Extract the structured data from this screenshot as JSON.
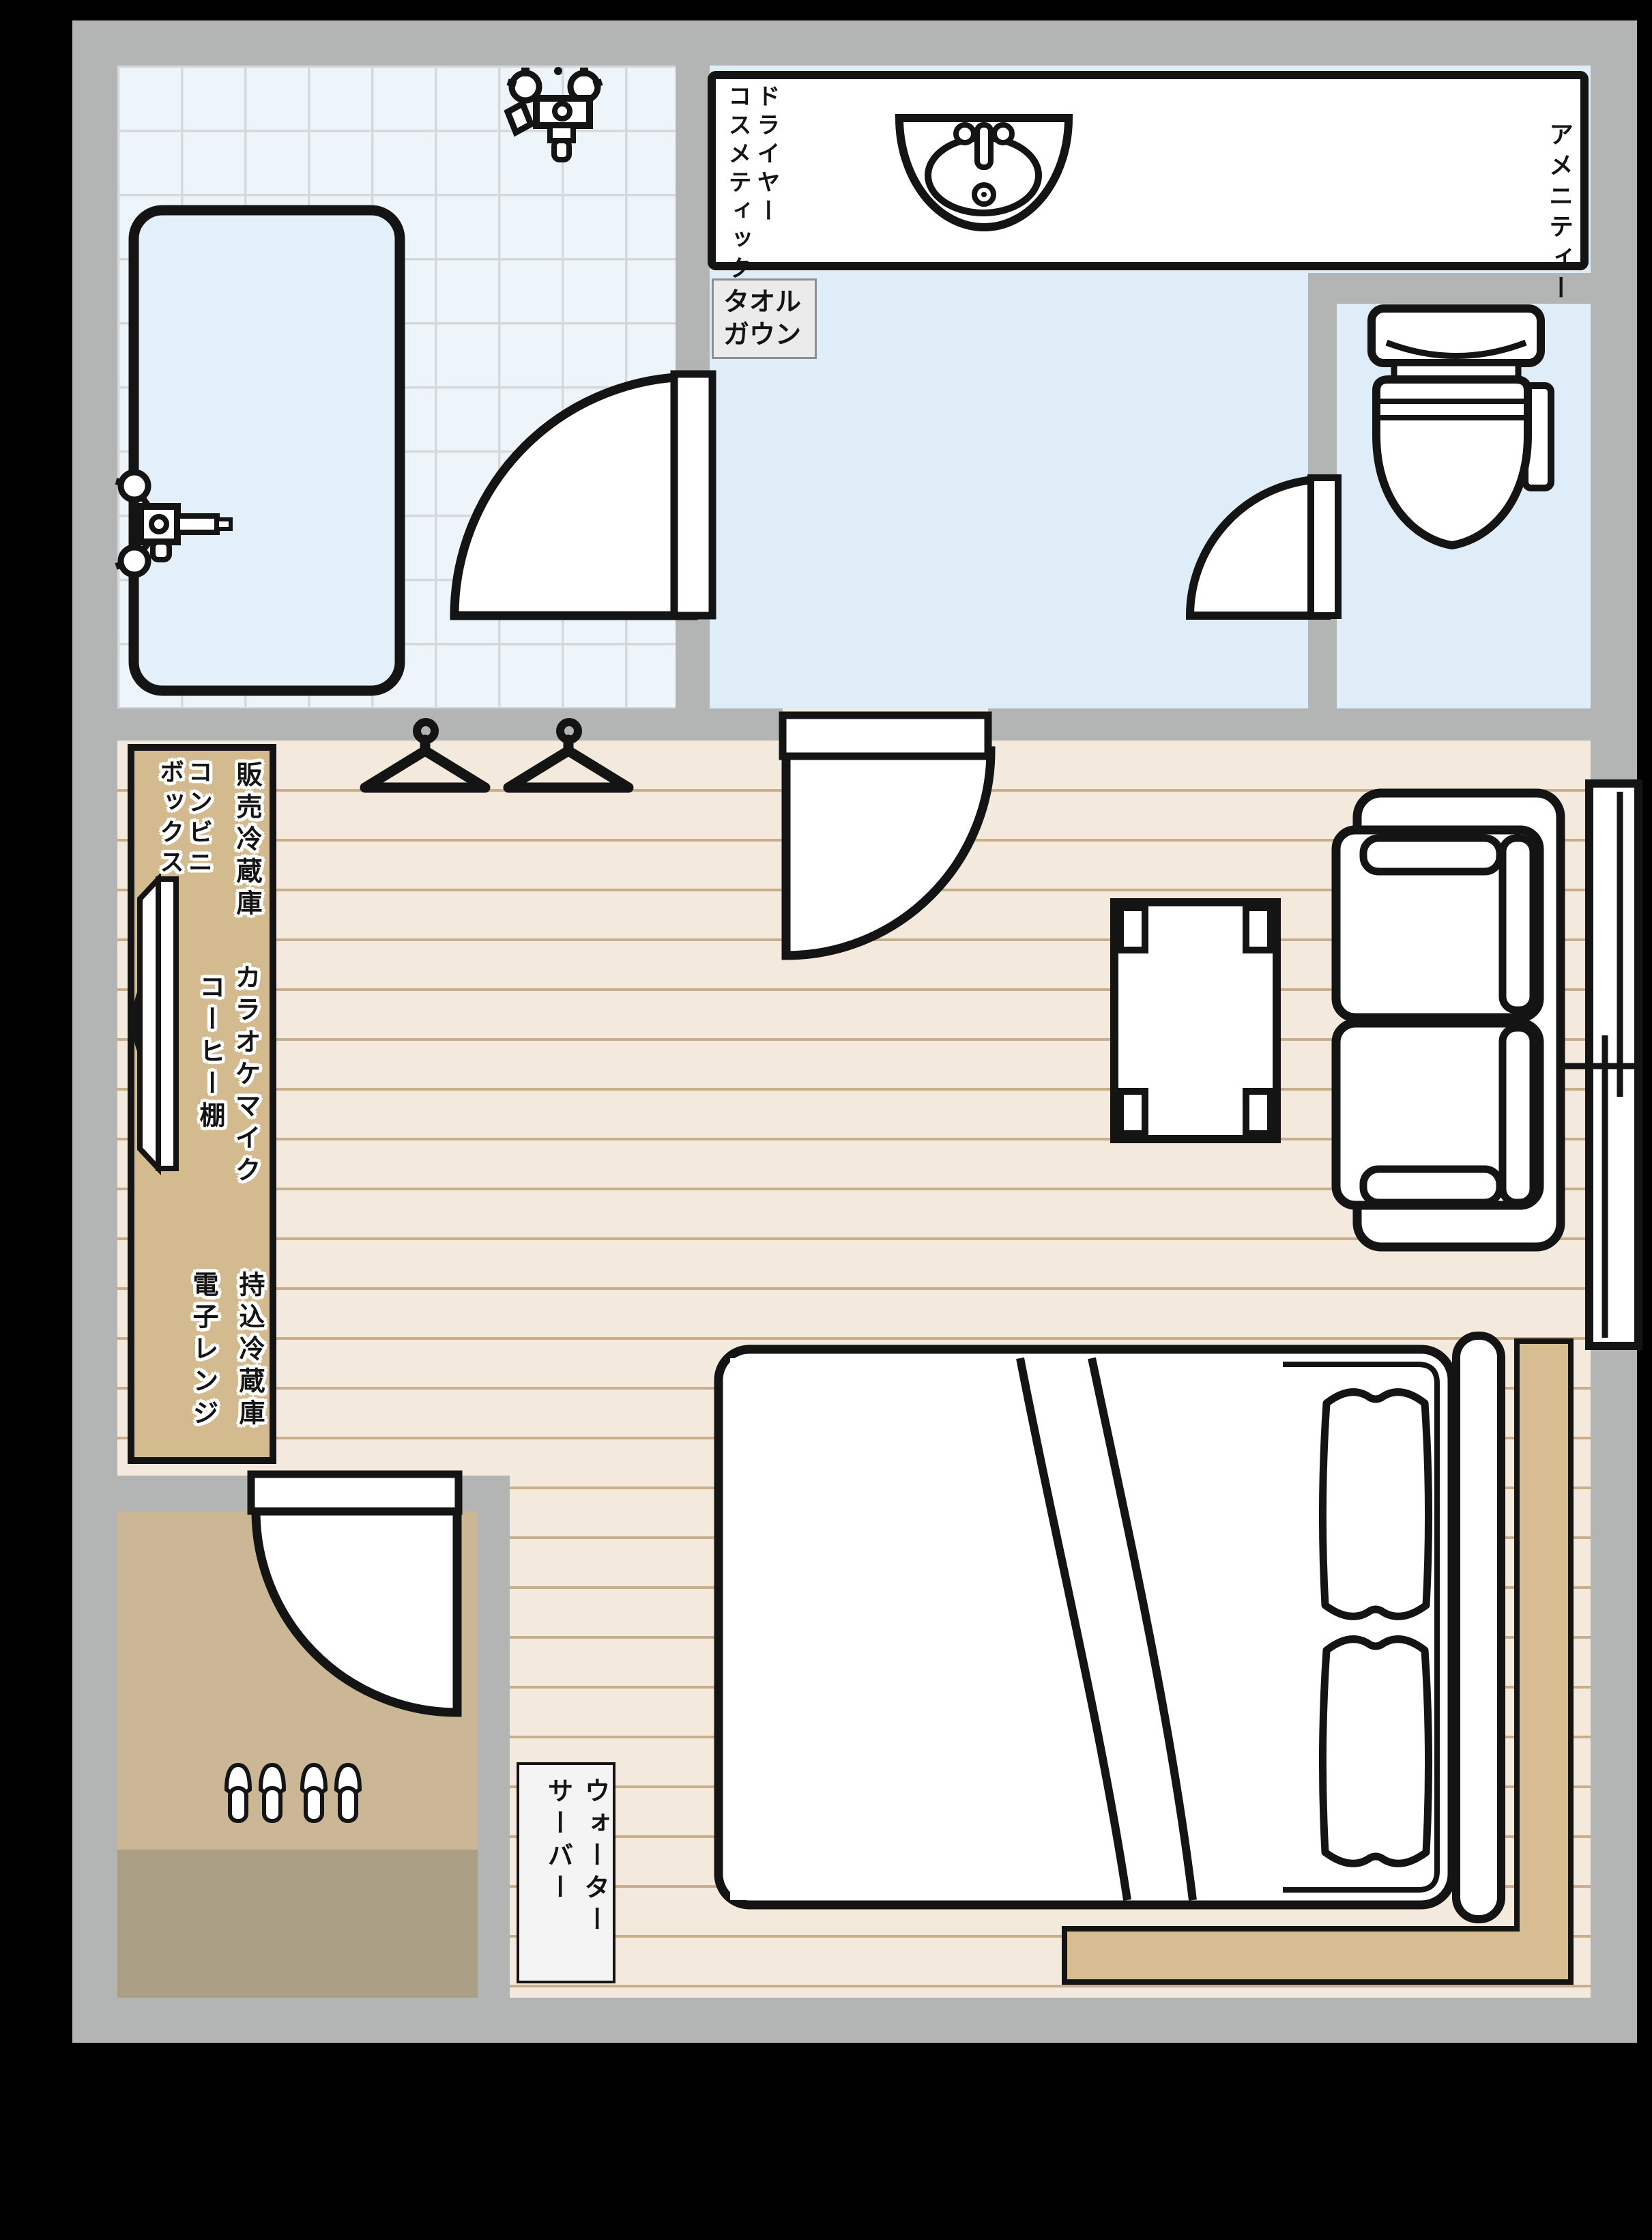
{
  "colors": {
    "background_black": "#000000",
    "wall_gray": "#b2b5b3",
    "tile_bg": "#edf5fa",
    "tile_line": "#d5d9db",
    "bathtub_fill": "#e4f0f9",
    "washroom_blue": "#dfedf8",
    "floor_wood": "#f3e9dd",
    "plank_line": "#c9ae8b",
    "cabinet_wood": "#d4ba8f",
    "platform_wood": "#d8bd92",
    "entry_step": "#cbb795",
    "entry_genkan": "#aa9e84",
    "label_box_bg": "#ebebeb",
    "line_ink": "#141414"
  },
  "washroom": {
    "counter_label": "ドライヤー\nコスメティック",
    "amenity_label": "アメニティー",
    "towel_gown_label": "タオル\nガウン"
  },
  "cabinet": {
    "vending_fridge": "販売冷蔵庫",
    "convenience_box": "コンビニ\nボックス",
    "karaoke_mic": "カラオケマイク",
    "coffee_shelf": "コーヒー棚",
    "carry_in_fridge": "持込冷蔵庫",
    "microwave": "電子レンジ"
  },
  "entrance_area": {
    "water_server_label": "ウォーター\nサーバー"
  }
}
